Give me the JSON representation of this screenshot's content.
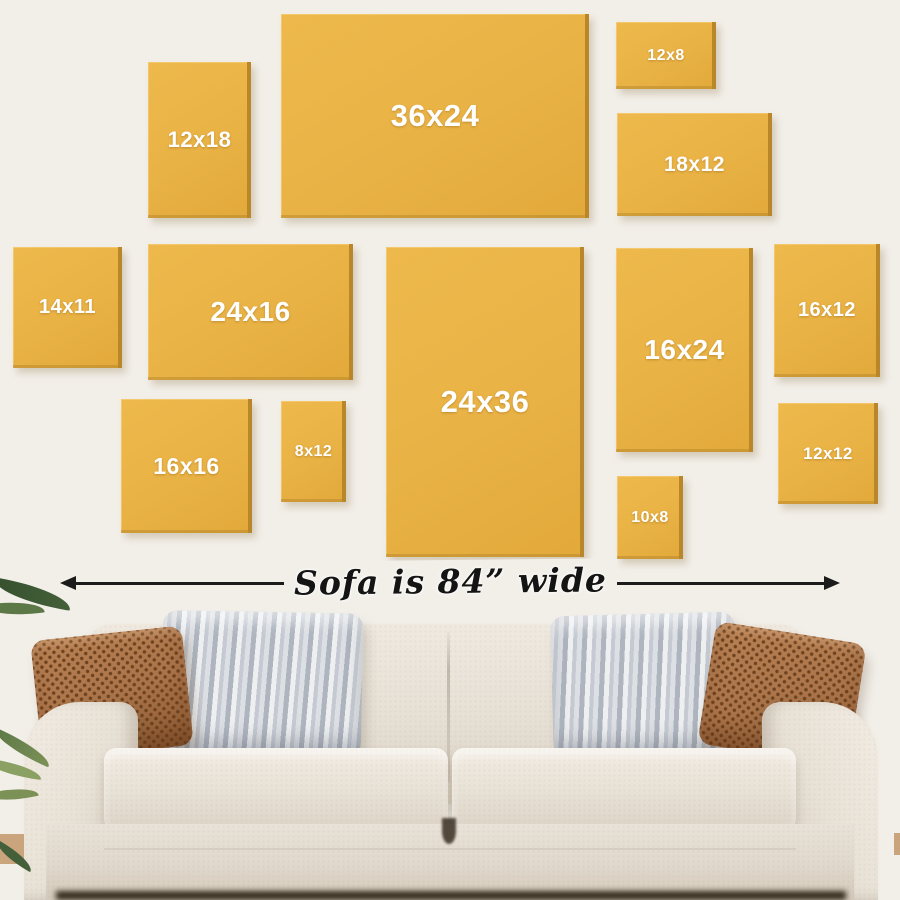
{
  "wall": {
    "background": "#f2efe9"
  },
  "frames": {
    "color": "#e9b245",
    "edge_color": "#b9872a",
    "label_color": "#ffffff",
    "items": [
      {
        "label": "12x18",
        "x": 148,
        "y": 62,
        "w": 103,
        "h": 156
      },
      {
        "label": "36x24",
        "x": 281,
        "y": 14,
        "w": 308,
        "h": 204
      },
      {
        "label": "12x8",
        "x": 616,
        "y": 22,
        "w": 100,
        "h": 67
      },
      {
        "label": "18x12",
        "x": 617,
        "y": 113,
        "w": 155,
        "h": 103
      },
      {
        "label": "14x11",
        "x": 13,
        "y": 247,
        "w": 109,
        "h": 121
      },
      {
        "label": "24x16",
        "x": 148,
        "y": 244,
        "w": 205,
        "h": 136
      },
      {
        "label": "24x36",
        "x": 386,
        "y": 247,
        "w": 198,
        "h": 310
      },
      {
        "label": "16x24",
        "x": 616,
        "y": 248,
        "w": 137,
        "h": 204
      },
      {
        "label": "16x12",
        "x": 774,
        "y": 244,
        "w": 106,
        "h": 133
      },
      {
        "label": "16x16",
        "x": 121,
        "y": 399,
        "w": 131,
        "h": 134
      },
      {
        "label": "8x12",
        "x": 281,
        "y": 401,
        "w": 65,
        "h": 101
      },
      {
        "label": "10x8",
        "x": 617,
        "y": 476,
        "w": 66,
        "h": 83
      },
      {
        "label": "12x12",
        "x": 778,
        "y": 403,
        "w": 100,
        "h": 101
      }
    ]
  },
  "dimension": {
    "label": "Sofa is 84” wide",
    "line_color": "#1b1b1b"
  },
  "sofa": {
    "fabric": "#e7e0d5",
    "fabric_shadow": "#d3c9ba",
    "pillow_brown": "#aa7349",
    "pillow_brown_dot": "#6e421f",
    "pillow_gray_light": "#edeff1",
    "pillow_gray_dark": "#aeb5bf",
    "floor": "#c9a47d"
  },
  "plant": {
    "greens": [
      "#44603a",
      "#5d7847",
      "#7b9156",
      "#8ba163"
    ]
  }
}
